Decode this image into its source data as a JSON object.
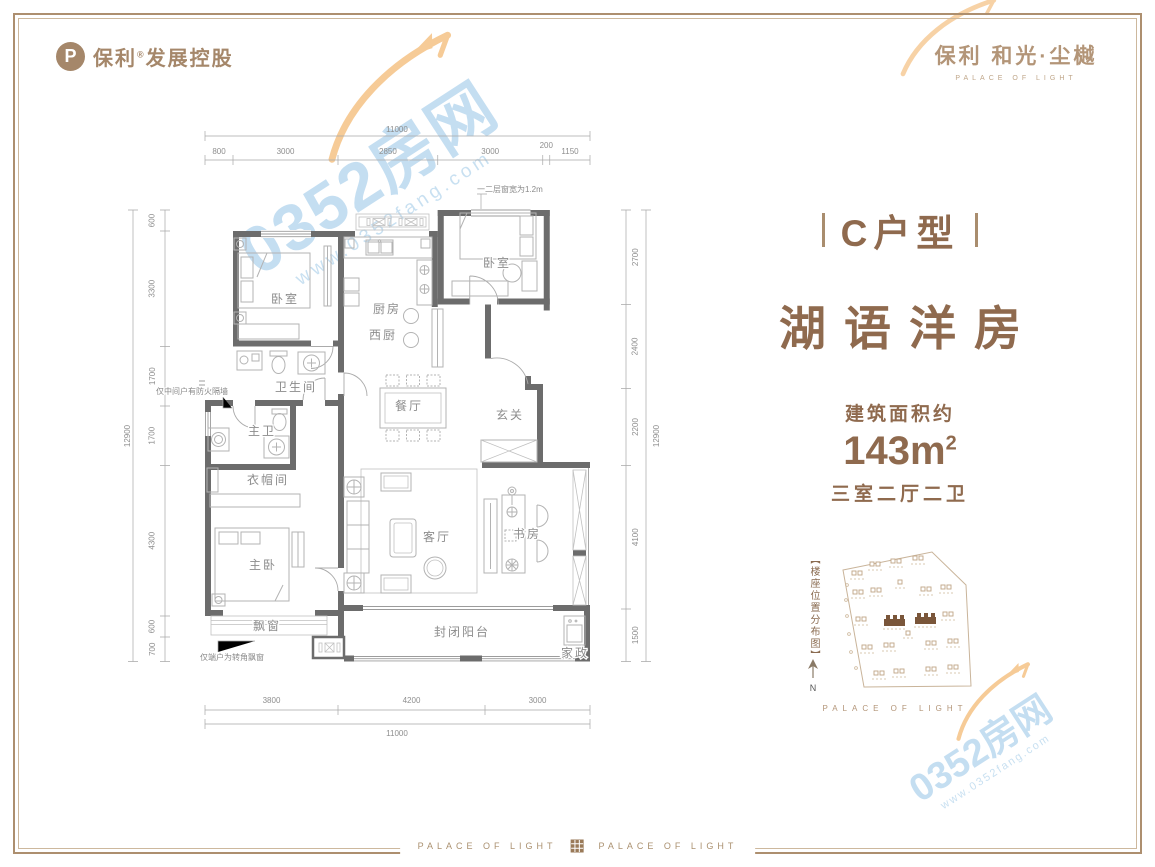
{
  "header": {
    "developer": {
      "brand": "保利",
      "reg": "®",
      "name": "发展控股",
      "mark": "P"
    },
    "project": {
      "cn": "保利 和光·尘樾",
      "en": "PALACE OF LIGHT"
    }
  },
  "unit": {
    "type": "C户型",
    "name": "湖语洋房",
    "area_label": "建筑面积约",
    "area_num": "143",
    "area_unit": "m",
    "area_sup": "2",
    "layout": "三室二厅二卫"
  },
  "plan": {
    "rooms": [
      "卧室",
      "厨房",
      "卧室",
      "西厨",
      "卫生间",
      "餐厅",
      "玄关",
      "主卫",
      "衣帽间",
      "主卧",
      "客厅",
      "书房",
      "飘窗",
      "封闭阳台",
      "家政"
    ],
    "notes": [
      "一二层窗宽为1.2m",
      "仅中间户有防火隔墙",
      "仅端户为转角飘窗"
    ],
    "dims": {
      "top": {
        "total": "11000",
        "segs": [
          "800",
          "3000",
          "2850",
          "3000",
          "200",
          "1150"
        ]
      },
      "bottom": {
        "total": "11000",
        "segs": [
          "3800",
          "4200",
          "3000"
        ]
      },
      "left": {
        "total": "12900",
        "segs": [
          "600",
          "3300",
          "1700",
          "1700",
          "4300",
          "600",
          "700"
        ]
      },
      "right": {
        "total": "12900",
        "segs": [
          "2700",
          "2400",
          "2200",
          "4100",
          "1500"
        ]
      }
    }
  },
  "site_plan": {
    "legend": "【楼座位置分布图】",
    "north": "N",
    "caption": "PALACE OF LIGHT"
  },
  "footer": {
    "left": "PALACE OF LIGHT",
    "right": "PALACE OF LIGHT"
  },
  "watermark": {
    "name": "0352房网",
    "url": "www.0352fang.com"
  },
  "colors": {
    "brand_brown": "#8f6a4e",
    "logo_tan": "#a5876a",
    "frame_tan": "#ad8f6f",
    "wall_gray": "#6c6c6c",
    "highlight_building": "#7a563a",
    "watermark_blue": "#bad8ee"
  }
}
